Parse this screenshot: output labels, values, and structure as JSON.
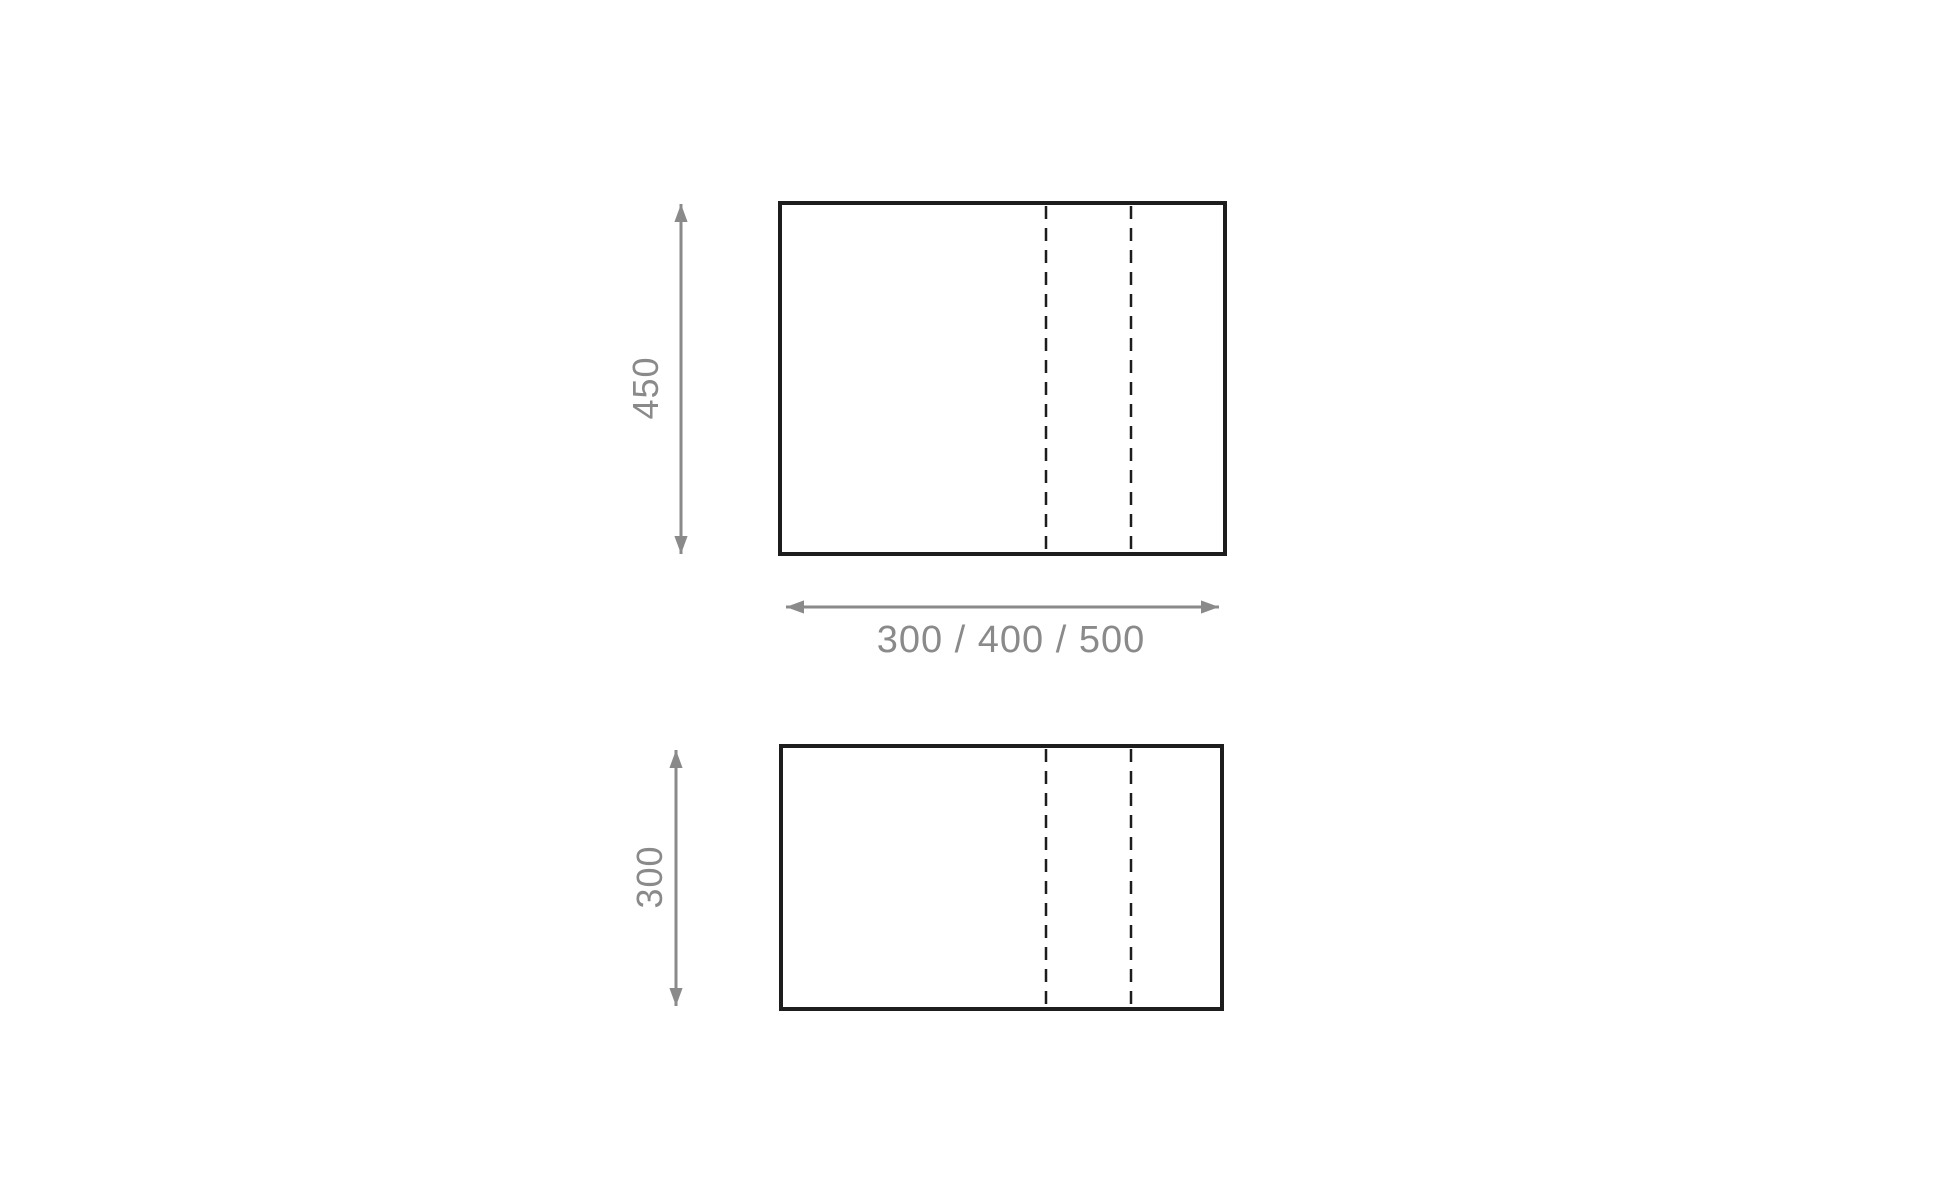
{
  "colors": {
    "background": "#ffffff",
    "outline": "#1d1d1d",
    "dimension": "#8a8a8a"
  },
  "diagram": {
    "front_view": {
      "height_label": "450"
    },
    "plan_view": {
      "height_label": "300"
    },
    "width_label": "300 / 400 / 500"
  }
}
